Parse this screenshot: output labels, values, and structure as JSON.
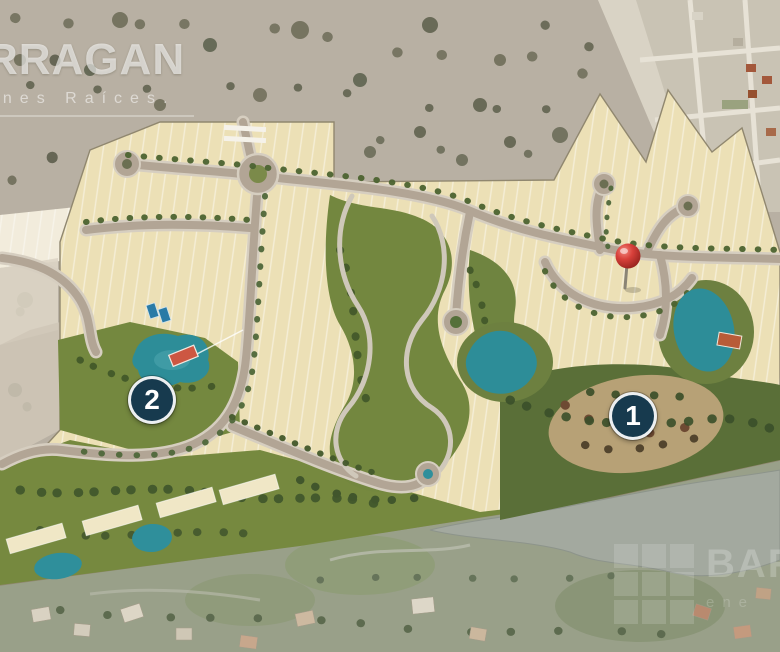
{
  "watermarks": {
    "top_left": {
      "line1": "RRAGAN",
      "line2": "enes Raíces."
    },
    "bottom_right": {
      "line1": "BARR",
      "line2": "ene"
    }
  },
  "markers": [
    {
      "label": "1"
    },
    {
      "label": "2"
    }
  ],
  "pin": {
    "name": "red-location-pin",
    "color": "#d8403a"
  },
  "colors": {
    "scrub_background": "#b8b0a3",
    "lot_beige": "#ece0b6",
    "road_gray": "#b2a595",
    "park_green": "#74883f",
    "forest_green": "#5a6f38",
    "pond_teal": "#2d8d98",
    "marker_navy": "#173a4e",
    "pin_red": "#d8403a",
    "photo_strip_base": "#99a089"
  }
}
